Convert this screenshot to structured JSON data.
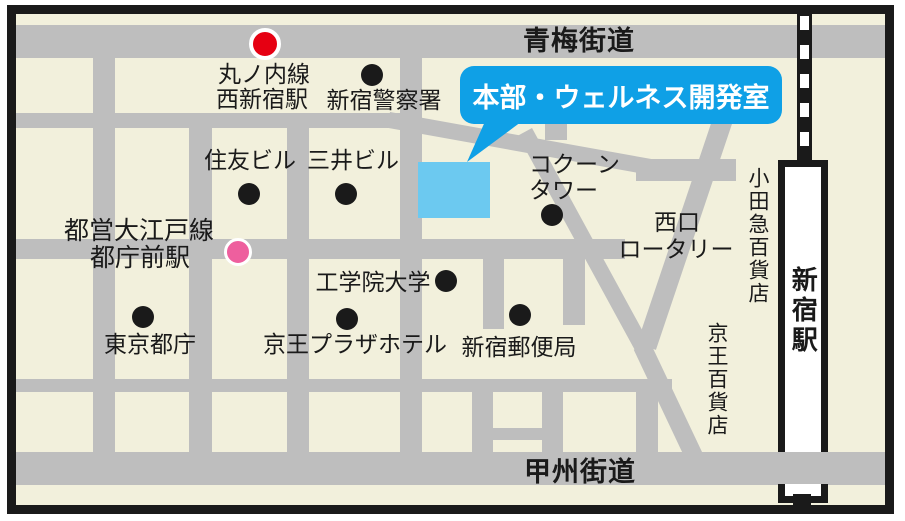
{
  "roads": {
    "ome_kaido": "青梅街道",
    "koshu_kaido": "甲州街道"
  },
  "callout": {
    "label": "本部・ウェルネス開発室"
  },
  "stations": {
    "marunouchi_l1": "丸ノ内線",
    "marunouchi_l2": "西新宿駅",
    "oedo_l1": "都営大江戸線",
    "oedo_l2": "都庁前駅",
    "shinjuku": "新宿駅"
  },
  "landmarks": {
    "police": "新宿警察署",
    "sumitomo": "住友ビル",
    "mitsui": "三井ビル",
    "cocoon_l1": "コクーン",
    "cocoon_l2": "タワー",
    "kogakuin": "工学院大学",
    "tocho": "東京都庁",
    "keio_plaza": "京王プラザホテル",
    "post_office": "新宿郵便局",
    "nishiguchi_l1": "西口",
    "nishiguchi_l2": "ロータリー",
    "odakyu_dept": "小田急百貨店",
    "keio_dept": "京王百貨店"
  },
  "colors": {
    "ink": "#1a1a1a",
    "road": "#bebebe",
    "bg": "#f2f0dc",
    "callout": "#0fa0e6",
    "building": "#6cc9f0",
    "red": "#e60012",
    "pink": "#ee5f9e",
    "white": "#ffffff"
  }
}
